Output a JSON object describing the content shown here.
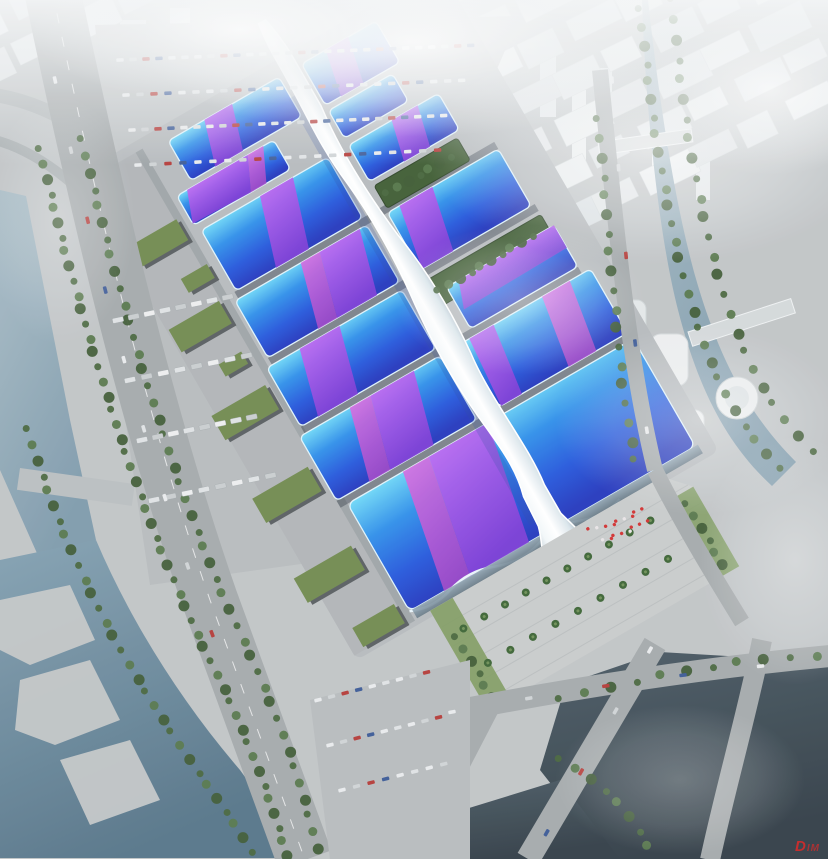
{
  "scene": {
    "description": "Aerial rendering of a riverside exhibition and convention center complex with blue and purple wavy hall roofs joined by a white serpentine central corridor, surrounded by highways, canals and a hazy white city",
    "hall_count": 12,
    "watermark": {
      "primary": "D",
      "secondary": "IM"
    },
    "palette": {
      "ground": "#b6babd",
      "plaza": "#c8cbcb",
      "road": "#a4a9ab",
      "road-light": "#b3b8ba",
      "roof-cyan": "#66d4f6",
      "roof-blue": "#2458dc",
      "ribbon-purple": "#9a4fe0",
      "ribbon-magenta": "#cc55d8",
      "spine-white": "#f2f7f9",
      "water-light": "#8aa2b0",
      "water-dark": "#3b4a53",
      "tree-green": "#47653c",
      "lawn-green": "#7d9a5e",
      "warehouse-green": "#70894f",
      "haze-white": "#f4f6f7",
      "flag-red": "#d03030",
      "watermark-red": "#d42b2b"
    }
  }
}
